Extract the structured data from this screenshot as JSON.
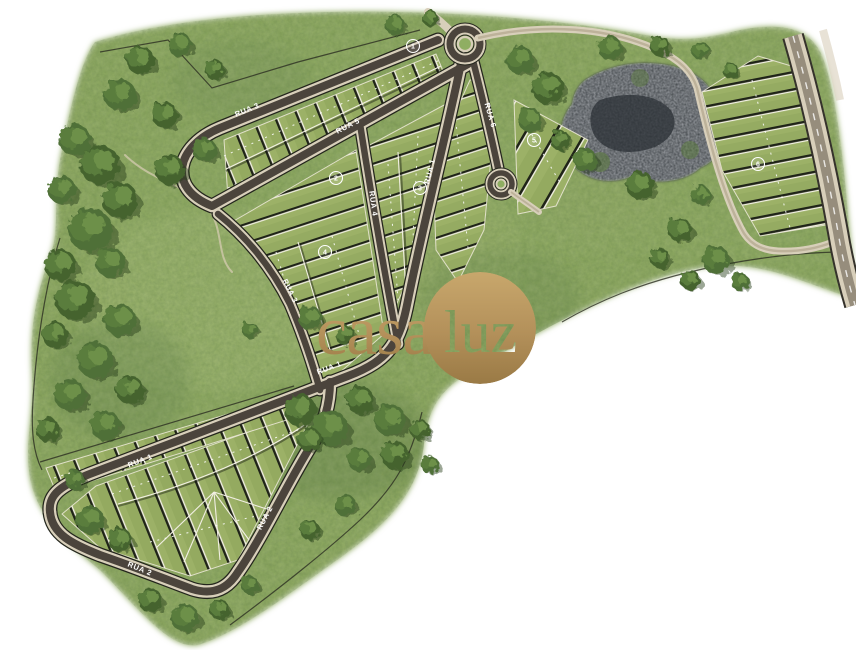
{
  "logo": {
    "full": "casaluz",
    "word_casa": "casa",
    "word_luz": "luz"
  },
  "street_labels": [
    {
      "name": "RUA 3"
    },
    {
      "name": "RUA 5"
    },
    {
      "name": "RUA 6"
    },
    {
      "name": "RUA 4"
    },
    {
      "name": "RUA 1"
    },
    {
      "name": "RUA 1"
    },
    {
      "name": "RUA 1"
    },
    {
      "name": "RUA 2"
    },
    {
      "name": "RUA 2"
    }
  ],
  "quadras": [
    {
      "number": "1"
    },
    {
      "number": "2"
    },
    {
      "number": "3"
    },
    {
      "number": "4"
    },
    {
      "number": "5"
    },
    {
      "number": "6"
    }
  ],
  "colors": {
    "background": "#ffffff",
    "gold": "#b3905a",
    "road_asphalt": "#4b443c",
    "road_sidewalk": "#d8cfba",
    "grass": "#8aa65c",
    "lot_green": "#9cb167",
    "rock": "#41464b"
  }
}
